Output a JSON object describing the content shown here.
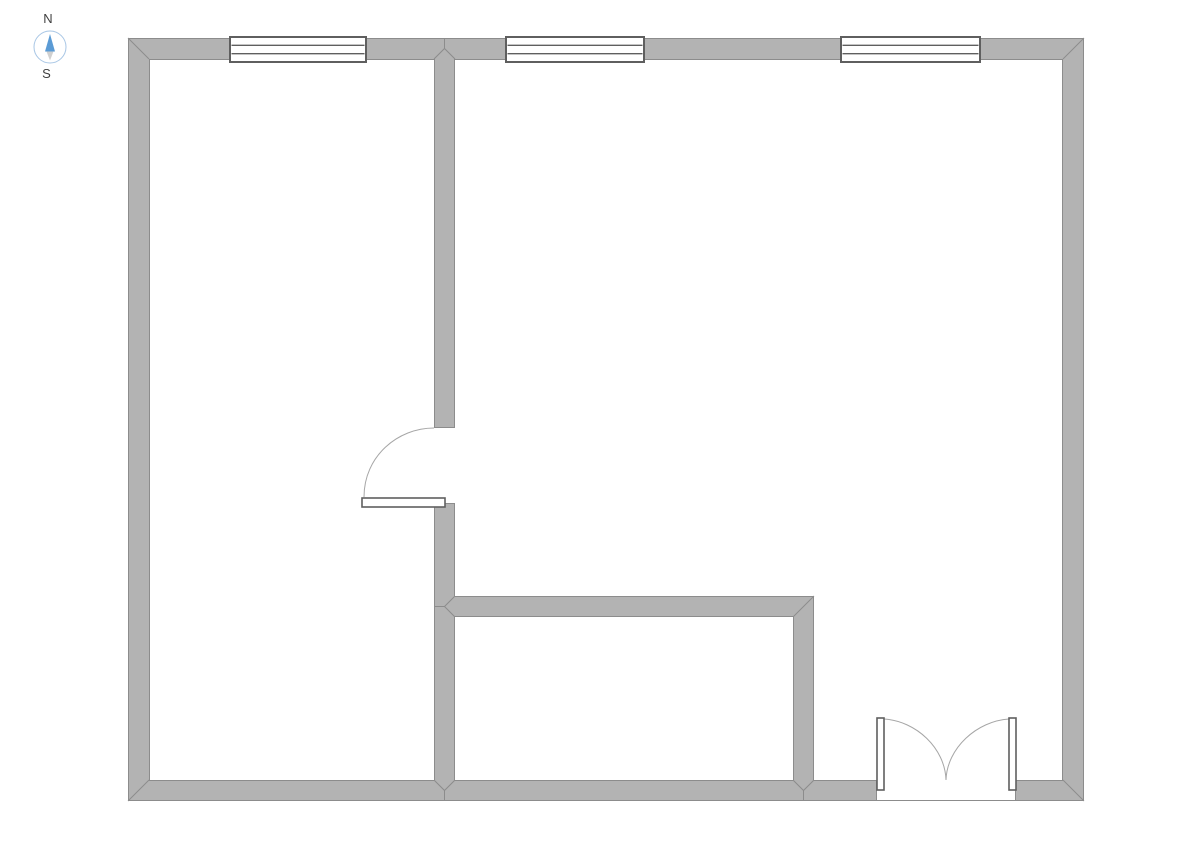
{
  "canvas": {
    "width": 1191,
    "height": 842,
    "background": "#ffffff"
  },
  "colors": {
    "wall_fill": "#b3b3b3",
    "wall_stroke": "#8c8c8c",
    "fixture_stroke": "#5f5f5f",
    "fixture_fill": "#ffffff",
    "swing_stroke": "#a6a6a6",
    "compass_ring": "#a8c6e5",
    "compass_north_fill": "#5b9bd5",
    "compass_south_fill": "#d0d0d0",
    "compass_text": "#404040"
  },
  "compass": {
    "north": "N",
    "south": "S"
  },
  "floorplan": {
    "walls": [
      {
        "name": "exterior-north",
        "x": 128,
        "y": 38,
        "w": 956,
        "h": 21
      },
      {
        "name": "exterior-west",
        "x": 128,
        "y": 38,
        "w": 21,
        "h": 763
      },
      {
        "name": "exterior-east",
        "x": 1063,
        "y": 38,
        "w": 21,
        "h": 763
      },
      {
        "name": "exterior-south-west-of-entry",
        "x": 128,
        "y": 780,
        "w": 748,
        "h": 21
      },
      {
        "name": "exterior-south-east-of-entry",
        "x": 1016,
        "y": 780,
        "w": 68,
        "h": 21
      },
      {
        "name": "interior-vertical-upper",
        "x": 434,
        "y": 59,
        "w": 21,
        "h": 369
      },
      {
        "name": "interior-vertical-lower",
        "x": 434,
        "y": 503,
        "w": 21,
        "h": 277
      },
      {
        "name": "interior-horizontal",
        "x": 434,
        "y": 596,
        "w": 380,
        "h": 21
      },
      {
        "name": "interior-vertical-right",
        "x": 793,
        "y": 596,
        "w": 21,
        "h": 184
      }
    ],
    "edges": [
      [
        128,
        38.5,
        1084,
        38.5
      ],
      [
        128.5,
        38,
        128.5,
        801
      ],
      [
        1083.5,
        38,
        1083.5,
        801
      ],
      [
        128,
        800.5,
        1084,
        800.5
      ],
      [
        149,
        59.5,
        434,
        59.5
      ],
      [
        149.5,
        59,
        149.5,
        780
      ],
      [
        149,
        780.5,
        434,
        780.5
      ],
      [
        434.5,
        59,
        434.5,
        428
      ],
      [
        434.5,
        503,
        434.5,
        780
      ],
      [
        455,
        59.5,
        1063,
        59.5
      ],
      [
        1062.5,
        59,
        1062.5,
        780
      ],
      [
        454.5,
        59,
        454.5,
        428
      ],
      [
        454.5,
        503,
        454.5,
        596
      ],
      [
        455,
        596.5,
        814,
        596.5
      ],
      [
        813.5,
        597,
        813.5,
        780
      ],
      [
        814,
        780.5,
        876,
        780.5
      ],
      [
        1016,
        780.5,
        1063,
        780.5
      ],
      [
        455,
        616.5,
        793,
        616.5
      ],
      [
        454.5,
        617,
        454.5,
        780
      ],
      [
        793.5,
        617,
        793.5,
        780
      ],
      [
        455,
        780.5,
        793,
        780.5
      ],
      [
        434,
        427.5,
        455,
        427.5
      ],
      [
        434,
        503.5,
        455,
        503.5
      ],
      [
        876.5,
        780,
        876.5,
        801
      ],
      [
        1015.5,
        780,
        1015.5,
        801
      ]
    ],
    "miters": [
      "128,38 149,59",
      "1084,38 1063,59",
      "128,801 149,780",
      "1084,801 1063,780",
      "434,59 444.5,48.5 455,59",
      "444.5,48.5 444.5,38",
      "434,780 444.5,790.5 455,780",
      "444.5,790.5 444.5,801",
      "793,780 803.5,790.5 814,780",
      "803.5,790.5 803.5,801",
      "455,596 444.5,606.5 455,617",
      "444.5,606.5 434,606.5",
      "814,596 793,617"
    ],
    "windows": [
      {
        "name": "window-1",
        "x": 230,
        "y": 37,
        "w": 136,
        "h": 25,
        "panes": 3
      },
      {
        "name": "window-2",
        "x": 506,
        "y": 37,
        "w": 138,
        "h": 25,
        "panes": 3
      },
      {
        "name": "window-3",
        "x": 841,
        "y": 37,
        "w": 139,
        "h": 25,
        "panes": 3
      }
    ],
    "doors": [
      {
        "name": "interior-door",
        "leaf": {
          "x": 362,
          "y": 498,
          "w": 83,
          "h": 9
        },
        "swing": "M 364 497 C 364 456 398 428 434 428"
      },
      {
        "name": "entry-double-door-left",
        "leaf": {
          "x": 877,
          "y": 718,
          "w": 7,
          "h": 72
        },
        "swing": "M 884 719 C 916 721 945 748 946 780"
      },
      {
        "name": "entry-double-door-right",
        "leaf": {
          "x": 1009,
          "y": 718,
          "w": 7,
          "h": 72
        },
        "swing": "M 1009 719 C 977 721 947 748 946 780"
      }
    ]
  }
}
